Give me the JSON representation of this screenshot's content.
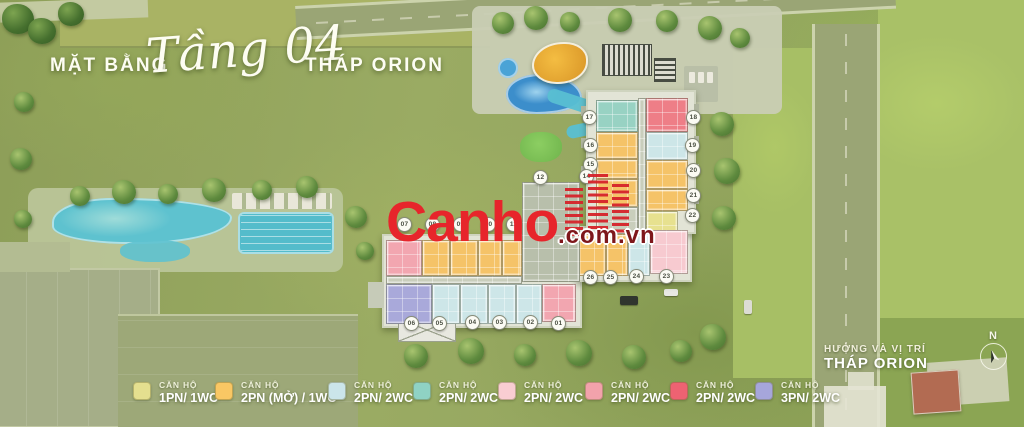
{
  "title": {
    "prefix": "MẶT BẰNG",
    "floor": "Tầng 04",
    "suffix": "THÁP ORION"
  },
  "watermark": {
    "brand": "Canho",
    "tld": ".com.vn",
    "color": "#e7252b"
  },
  "compass": {
    "north_label": "N"
  },
  "location_note": {
    "line1": "HƯỚNG VÀ VỊ TRÍ",
    "line2": "THÁP ORION"
  },
  "legend": {
    "category_label": "CĂN HỘ",
    "items": [
      {
        "type": "1PN/ 1WC",
        "color": "#e4df8f",
        "x": 133
      },
      {
        "type": "2PN (MỞ) / 1WC",
        "color": "#f9c764",
        "x": 215
      },
      {
        "type": "2PN/ 2WC",
        "color": "#cbe5ea",
        "x": 328
      },
      {
        "type": "2PN/ 2WC",
        "color": "#8fd2c4",
        "x": 413
      },
      {
        "type": "2PN/ 2WC",
        "color": "#f9cdd2",
        "x": 498
      },
      {
        "type": "2PN/ 2WC",
        "color": "#f2a2ab",
        "x": 585
      },
      {
        "type": "2PN/ 2WC",
        "color": "#ee6272",
        "x": 670
      },
      {
        "type": "3PN/ 2WC",
        "color": "#a6a6db",
        "x": 755
      }
    ]
  },
  "plan": {
    "unit_colors": {
      "yellow": "#f5c368",
      "pale": "#e7e18f",
      "teal": "#98d2c3",
      "blue": "#cde6e8",
      "red": "#ee7e87",
      "pinkL": "#f7cad0",
      "pink": "#f2a6b0",
      "lav": "#a9a9da",
      "core": "#b8bfab",
      "grey": "#c9cebc"
    },
    "units": [
      {
        "no": "17",
        "t": "teal",
        "x": 596,
        "y": 100,
        "w": 42,
        "h": 32,
        "cx": 590,
        "cy": 118
      },
      {
        "no": "16",
        "t": "yellow",
        "x": 596,
        "y": 132,
        "w": 42,
        "h": 27,
        "cx": 591,
        "cy": 146
      },
      {
        "no": "15",
        "t": "yellow",
        "x": 596,
        "y": 159,
        "w": 42,
        "h": 20,
        "cx": 591,
        "cy": 165
      },
      {
        "no": "14",
        "t": "yellow",
        "x": 596,
        "y": 179,
        "w": 42,
        "h": 28,
        "cx": 587,
        "cy": 177
      },
      {
        "t": "grey",
        "x": 596,
        "y": 207,
        "w": 42,
        "h": 27
      },
      {
        "t": "grey",
        "x": 638,
        "y": 98,
        "w": 8,
        "h": 136
      },
      {
        "no": "18",
        "t": "red",
        "x": 646,
        "y": 98,
        "w": 42,
        "h": 34,
        "cx": 694,
        "cy": 118
      },
      {
        "no": "19",
        "t": "blue",
        "x": 646,
        "y": 132,
        "w": 42,
        "h": 28,
        "cx": 693,
        "cy": 146
      },
      {
        "no": "20",
        "t": "yellow",
        "x": 646,
        "y": 160,
        "w": 42,
        "h": 29,
        "cx": 694,
        "cy": 171
      },
      {
        "no": "21",
        "t": "yellow",
        "x": 646,
        "y": 189,
        "w": 42,
        "h": 22,
        "cx": 694,
        "cy": 196
      },
      {
        "no": "22",
        "t": "pale",
        "x": 646,
        "y": 211,
        "w": 32,
        "h": 22,
        "cx": 693,
        "cy": 216
      },
      {
        "no": "26",
        "t": "yellow",
        "x": 578,
        "y": 234,
        "w": 28,
        "h": 42,
        "cx": 591,
        "cy": 278
      },
      {
        "no": "25",
        "t": "yellow",
        "x": 606,
        "y": 234,
        "w": 22,
        "h": 42,
        "cx": 611,
        "cy": 278
      },
      {
        "no": "24",
        "t": "blue",
        "x": 628,
        "y": 234,
        "w": 22,
        "h": 42,
        "cx": 637,
        "cy": 277
      },
      {
        "no": "23",
        "t": "pinkL",
        "x": 650,
        "y": 230,
        "w": 38,
        "h": 44,
        "cx": 667,
        "cy": 277
      },
      {
        "t": "core",
        "x": 522,
        "y": 182,
        "w": 58,
        "h": 100
      },
      {
        "no": "12",
        "cx": 541,
        "cy": 178
      },
      {
        "no": "07",
        "t": "pink",
        "x": 386,
        "y": 240,
        "w": 36,
        "h": 36,
        "cx": 405,
        "cy": 225
      },
      {
        "no": "08",
        "t": "yellow",
        "x": 422,
        "y": 240,
        "w": 28,
        "h": 36,
        "cx": 433,
        "cy": 225
      },
      {
        "no": "09",
        "t": "yellow",
        "x": 450,
        "y": 240,
        "w": 28,
        "h": 36,
        "cx": 461,
        "cy": 225
      },
      {
        "no": "10",
        "t": "yellow",
        "x": 478,
        "y": 240,
        "w": 24,
        "h": 36,
        "cx": 489,
        "cy": 225
      },
      {
        "no": "11",
        "t": "yellow",
        "x": 502,
        "y": 240,
        "w": 20,
        "h": 36,
        "cx": 514,
        "cy": 225
      },
      {
        "t": "grey",
        "x": 386,
        "y": 276,
        "w": 136,
        "h": 8
      },
      {
        "no": "06",
        "t": "lav",
        "x": 386,
        "y": 284,
        "w": 46,
        "h": 40,
        "cx": 412,
        "cy": 324
      },
      {
        "no": "05",
        "t": "blue",
        "x": 432,
        "y": 284,
        "w": 28,
        "h": 40,
        "cx": 440,
        "cy": 324
      },
      {
        "no": "04",
        "t": "blue",
        "x": 460,
        "y": 284,
        "w": 28,
        "h": 40,
        "cx": 473,
        "cy": 323
      },
      {
        "no": "03",
        "t": "blue",
        "x": 488,
        "y": 284,
        "w": 28,
        "h": 40,
        "cx": 500,
        "cy": 323
      },
      {
        "no": "02",
        "t": "blue",
        "x": 516,
        "y": 284,
        "w": 26,
        "h": 40,
        "cx": 531,
        "cy": 323
      },
      {
        "no": "01",
        "t": "pink",
        "x": 542,
        "y": 284,
        "w": 34,
        "h": 38,
        "cx": 559,
        "cy": 324
      }
    ]
  }
}
